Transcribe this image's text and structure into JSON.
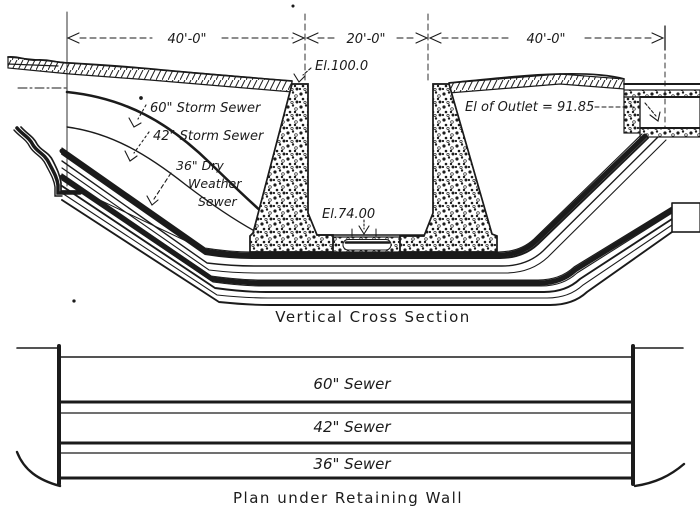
{
  "colors": {
    "ink": "#1b1b1b",
    "paper": "#ffffff"
  },
  "cross_section": {
    "caption": "Vertical Cross Section",
    "dim_left": "40'-0\"",
    "dim_mid": "20'-0\"",
    "dim_right": "40'-0\"",
    "el_top": "El.100.0",
    "el_floor": "El.74.00",
    "el_outlet": "El of Outlet = 91.85",
    "sewer60_label": "60\" Storm Sewer",
    "sewer42_label": "42\" Storm Sewer",
    "sewer36_line1": "36\" Dry",
    "sewer36_line2": "Weather",
    "sewer36_line3": "Sewer"
  },
  "plan": {
    "caption": "Plan under Retaining Wall",
    "sewer60": "60\" Sewer",
    "sewer42": "42\" Sewer",
    "sewer36": "36\" Sewer"
  }
}
